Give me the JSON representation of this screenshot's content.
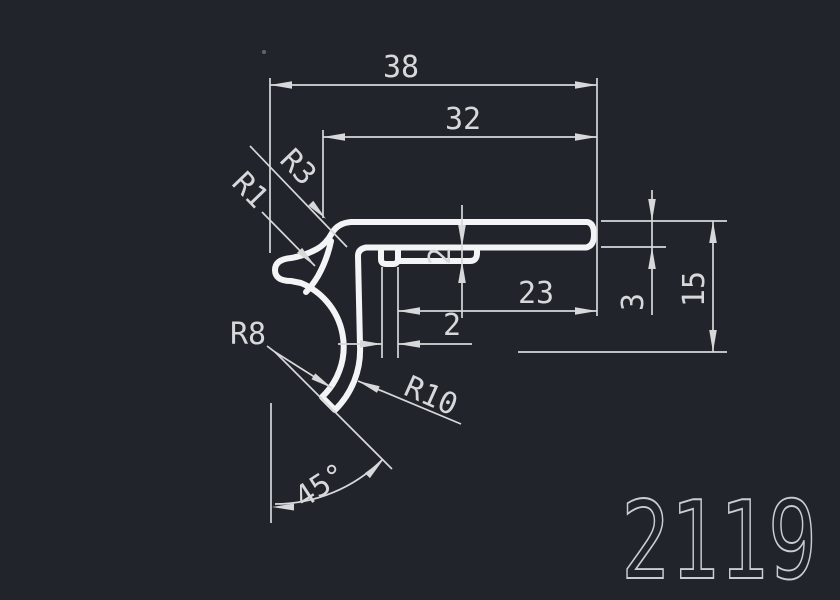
{
  "drawing": {
    "title": "CAD profile section drawing",
    "part_number": "2119",
    "colors": {
      "background": "#21252b",
      "profile_line": "#f3f4f5",
      "dimension_line": "#d6d8da"
    },
    "dims": {
      "width_overall": "38",
      "width_upper": "32",
      "width_right": "23",
      "slot_width": "2",
      "lip_thickness": "2",
      "flange_thickness": "3",
      "height": "15",
      "angle": "45°",
      "r1": "R1",
      "r3": "R3",
      "r8": "R8",
      "r10": "R10"
    }
  }
}
